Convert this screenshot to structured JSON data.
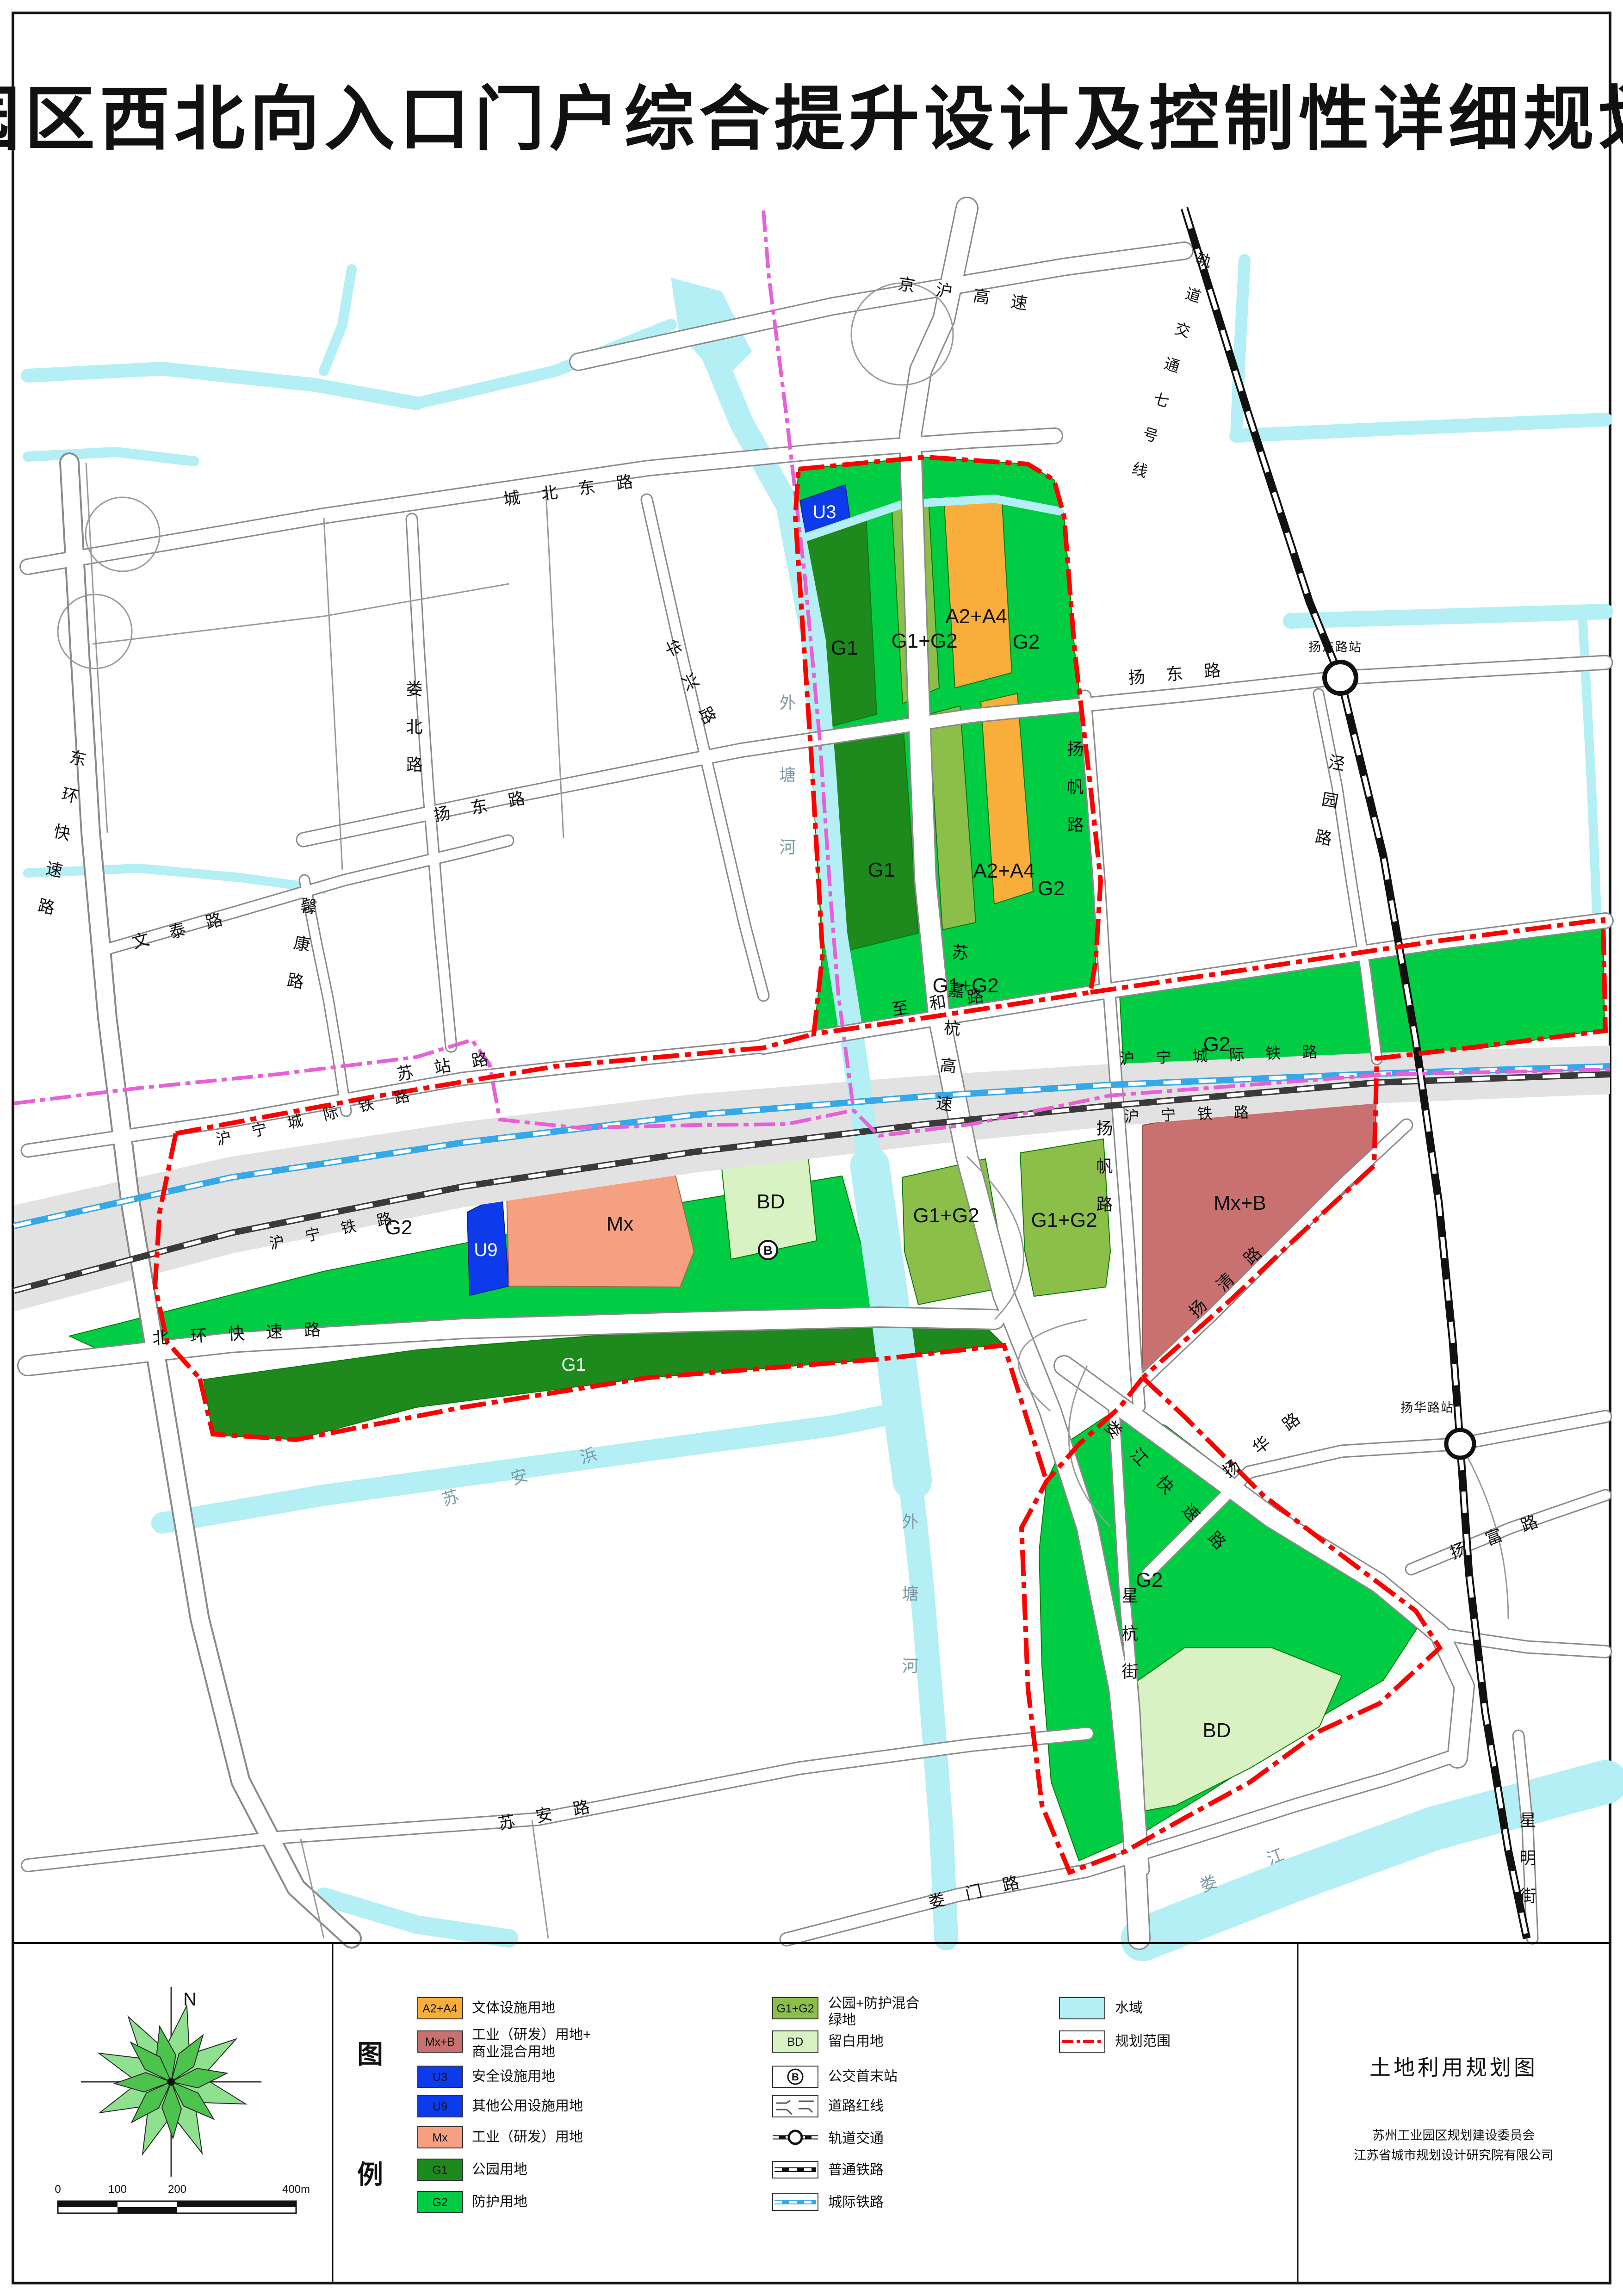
{
  "title": "园区西北向入口门户综合提升设计及控制性详细规划",
  "map": {
    "roads": {
      "chengbeidong": "城北东路",
      "yangdong": "扬东路",
      "zhihe": "至和路",
      "suzhan": "苏站路",
      "loubei": "娄北路",
      "huaxing": "华兴路",
      "wentai": "文泰路",
      "xinkang": "馨康路",
      "donghuan": "东环快速路",
      "beihuan": "北环快速路",
      "suan": "苏安路",
      "sujiahang": "苏嘉杭高速",
      "yangfan": "扬帆路",
      "loujiangks": "娄江快速路",
      "loumen": "娄门路",
      "xinghang": "星杭街",
      "xingming": "星明街",
      "yangfu": "扬富路",
      "yanghua": "扬华路",
      "yangqing": "扬清路",
      "jingyuan": "泾园路",
      "jinghu": "京沪高速"
    },
    "rails": {
      "metro7": "轨道交通七号线",
      "huningcj": "沪宁城际铁路",
      "huningtl": "沪宁铁路"
    },
    "rivers": {
      "waitanghe": "外塘河",
      "suanbang": "苏安浜",
      "loujiang": "娄江"
    },
    "stations": {
      "yangdongzhan": "扬东路站",
      "yanghuazhan": "扬华路站"
    },
    "parcels": {
      "u3": "U3",
      "u9": "U9",
      "g1": "G1",
      "g2": "G2",
      "g1g2": "G1+G2",
      "a2a4": "A2+A4",
      "mx": "Mx",
      "mxb": "Mx+B",
      "bd": "BD",
      "bus": "B"
    }
  },
  "legend": {
    "header_char1": "图",
    "header_char2": "例",
    "col1": [
      {
        "code": "A2+A4",
        "label": "文体设施用地"
      },
      {
        "code": "Mx+B",
        "label": "工业（研发）用地+",
        "label2": "商业混合用地"
      },
      {
        "code": "U3",
        "label": "安全设施用地"
      },
      {
        "code": "U9",
        "label": "其他公用设施用地"
      },
      {
        "code": "Mx",
        "label": "工业（研发）用地"
      },
      {
        "code": "G1",
        "label": "公园用地"
      },
      {
        "code": "G2",
        "label": "防护用地"
      }
    ],
    "col2": [
      {
        "code": "G1+G2",
        "label": "公园+防护混合",
        "label2": "绿地"
      },
      {
        "code": "BD",
        "label": "留白用地"
      },
      {
        "code": "B",
        "label": "公交首末站"
      },
      {
        "label": "道路红线"
      },
      {
        "label": "轨道交通"
      },
      {
        "label": "普通铁路"
      },
      {
        "label": "城际铁路"
      }
    ],
    "col3": [
      {
        "label": "水域"
      },
      {
        "label": "规划范围"
      }
    ]
  },
  "compass": {
    "north": "N"
  },
  "scalebar": {
    "t0": "0",
    "t100": "100",
    "t200": "200",
    "t400": "400m"
  },
  "footer": {
    "map_name": "土地利用规划图",
    "org1": "苏州工业园区规划建设委员会",
    "org2": "江苏省城市规划设计研究院有限公司"
  },
  "colors": {
    "g1": "#1E8A1E",
    "g2": "#00CC44",
    "g1g2": "#8CBE4A",
    "a2a4": "#F9AE3B",
    "mx": "#F6A083",
    "mxb": "#C97070",
    "u_blue": "#0D3BEB",
    "bd": "#D9F2C4",
    "water": "#B3EFF4",
    "boundary_red": "#FF0000",
    "admin_magenta": "#E860D8",
    "intercity_blue": "#35A9E8"
  }
}
